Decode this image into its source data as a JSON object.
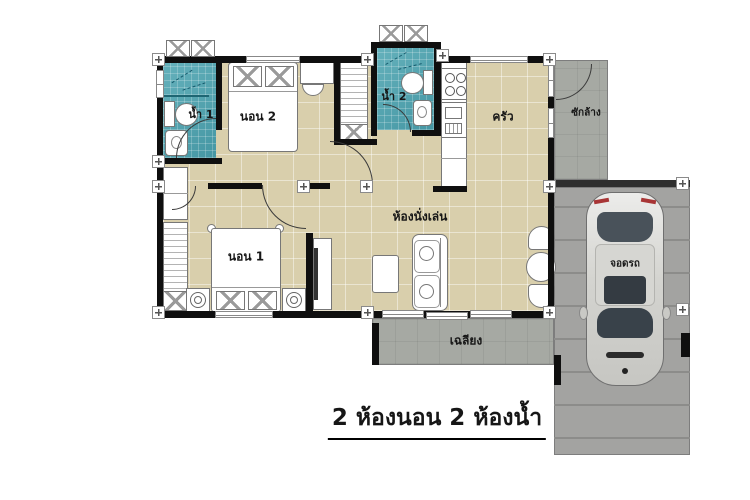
{
  "title": {
    "text": "2 ห้องนอน 2 ห้องน้ำ"
  },
  "rooms": {
    "bath1": {
      "label": "น้ำ 1"
    },
    "bed2": {
      "label": "นอน 2"
    },
    "bath2": {
      "label": "น้ำ 2"
    },
    "kitchen": {
      "label": "ครัว"
    },
    "laundry": {
      "label": "ซักล้าง"
    },
    "living": {
      "label": "ห้องนั่งเล่น"
    },
    "bed1": {
      "label": "นอน 1"
    },
    "porch": {
      "label": "เฉลียง"
    },
    "parking": {
      "label": "จอดรถ"
    }
  },
  "palette": {
    "floor_beige": "#d9cfac",
    "bathroom_teal": "#4fa6b2",
    "concrete_gray": "#a6a9a3",
    "wall_black": "#0f0f0f",
    "car_silver": "#d8d8d4"
  }
}
